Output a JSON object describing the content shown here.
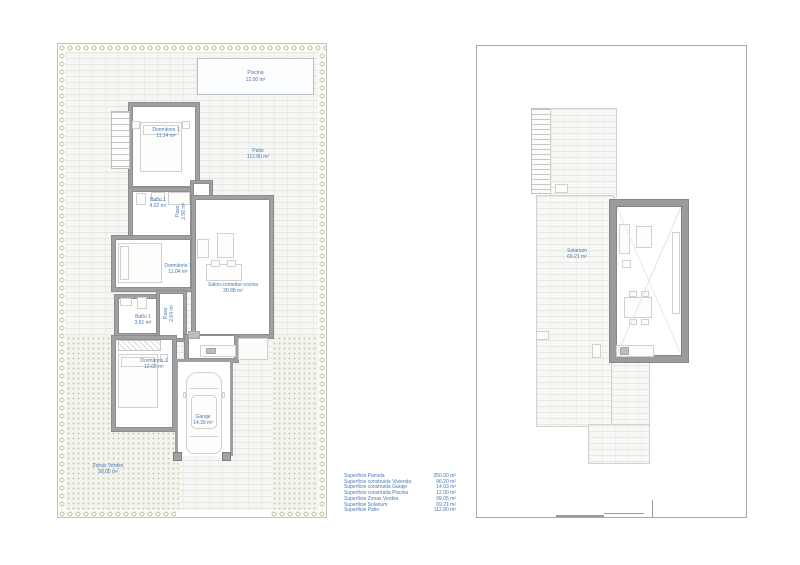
{
  "colors": {
    "label_blue": "#4a78b4",
    "wall_gray": "#9e9e9e",
    "hedge_green": "#c9cdaa",
    "grass_dot": "#c8cfae",
    "paving": "#f6f6f4"
  },
  "ground_plan": {
    "pool": {
      "name": "Piscina",
      "area": "12.00 m²"
    },
    "patio": {
      "name": "Patio",
      "area": "112.80 m²"
    },
    "green_zone": {
      "name": "Zonas Verdes",
      "area": "99.05 m²"
    },
    "rooms": {
      "dorm_top": {
        "name": "Dormitorio 1",
        "area": "11.14 m²"
      },
      "bath_top": {
        "name": "Baño 1",
        "area": "4.02 m²"
      },
      "paso_top": {
        "name": "Paso",
        "area": "2.56 m²"
      },
      "dorm_mid": {
        "name": "Dormitorio 1",
        "area": "11.04 m²"
      },
      "salon": {
        "name": "Salon-comedor-cocina",
        "area": "30.88 m²"
      },
      "bath_bot": {
        "name": "Baño 1",
        "area": "3.91 m²"
      },
      "paso_bot": {
        "name": "Paso",
        "area": "2.64 m²"
      },
      "dorm_bot": {
        "name": "Dormitorio 1",
        "area": "12.03 m²"
      },
      "garage": {
        "name": "Garaje",
        "area": "14.39 m²"
      }
    }
  },
  "roof_plan": {
    "solarium": {
      "name": "Solarium",
      "area": "69.21 m²"
    }
  },
  "legend": {
    "rows": [
      {
        "label": "Superficie Parcela",
        "value": "350.00 m²"
      },
      {
        "label": "Superficie construida Vivienda",
        "value": "96.20 m²"
      },
      {
        "label": "Superficie construida Garaje",
        "value": "14.63 m²"
      },
      {
        "label": "Superficie construida Piscina",
        "value": "12.00 m²"
      },
      {
        "label": "Superficie Zonas Verdes",
        "value": "99.05 m²"
      },
      {
        "label": "Superficie Solarium",
        "value": "69.21 m²"
      },
      {
        "label": "Superficie Patio",
        "value": "112.80 m²"
      }
    ]
  }
}
